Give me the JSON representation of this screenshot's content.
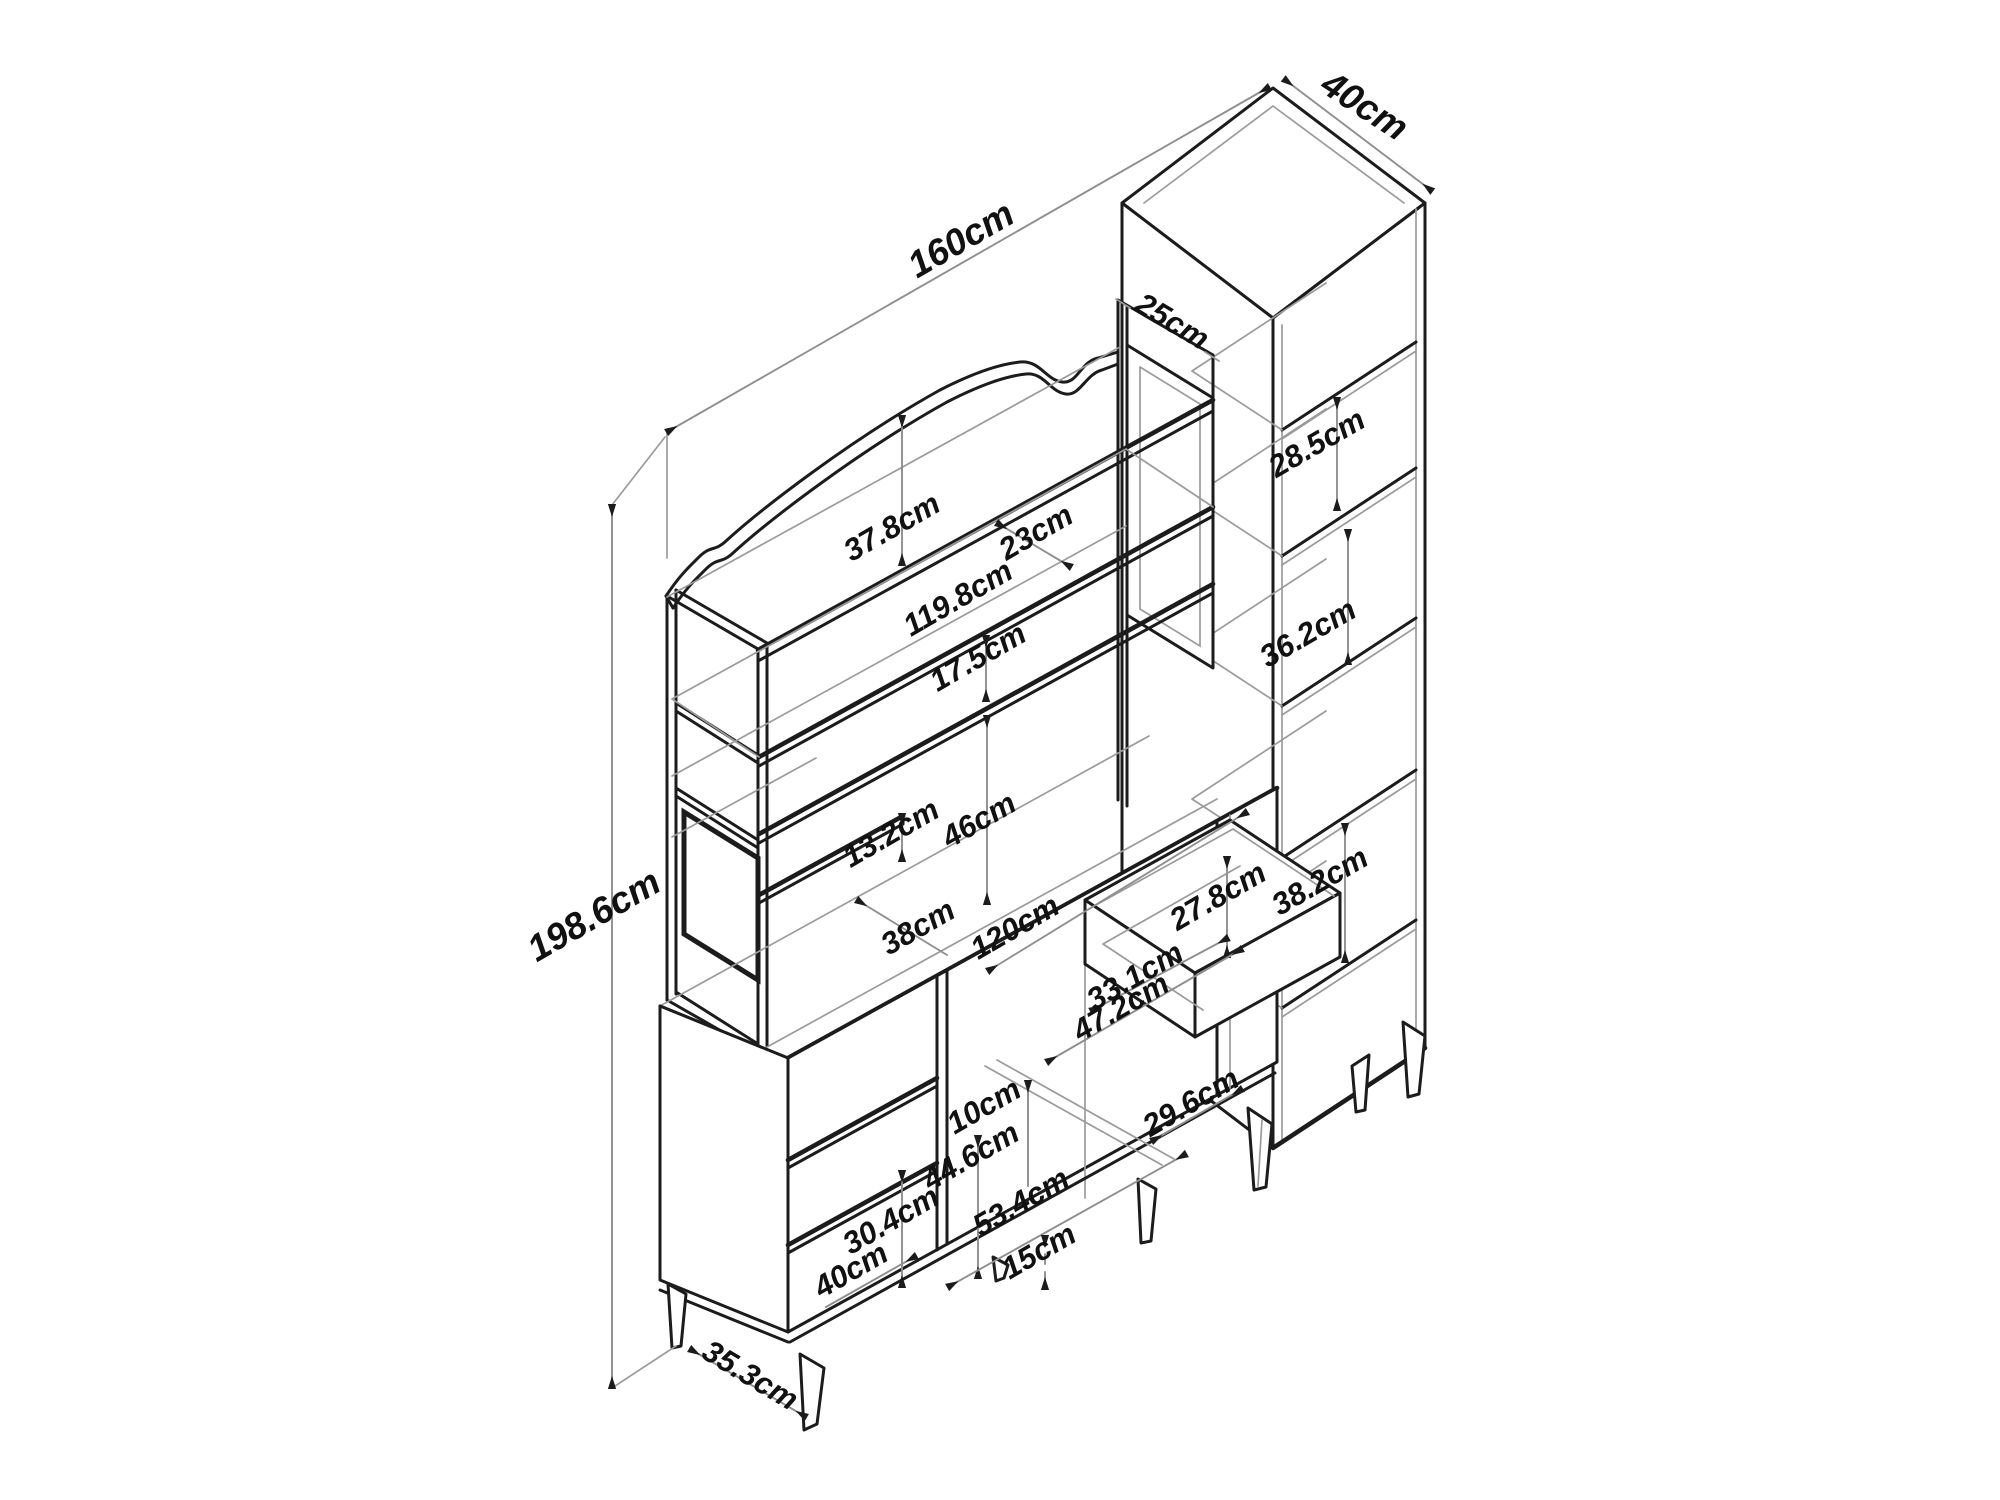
{
  "diagram_title": "furniture dimension drawing",
  "unit": "cm",
  "colors": {
    "line": "#1c1c1c",
    "dim_line": "#8f8f8f",
    "background": "#ffffff"
  },
  "dims": {
    "overall_width": "160cm",
    "overall_height": "198.6cm",
    "tower_depth": "40cm",
    "hutch_depth": "25cm",
    "tower_gap_top": "28.5cm",
    "tower_gap_middle": "36.2cm",
    "tower_gap_bottom": "38.2cm",
    "crest_height": "37.8cm",
    "top_shelf_depth": "23cm",
    "hutch_shelf_width": "119.8cm",
    "shelf_gap_upper": "17.5cm",
    "shelf_gap_lower": "13.2cm",
    "hutch_opening_height": "46cm",
    "side_shelf_width": "38cm",
    "desk_width": "120cm",
    "niche_height": "27.8cm",
    "drawer_inner_width": "33.1cm",
    "drawer_inner_depth": "47.2cm",
    "drawer_top_gap": "10cm",
    "base_gap_width": "29.6cm",
    "door_opening_height": "44.6cm",
    "cubby_height": "30.4cm",
    "base_rail_width": "53.4cm",
    "leg_height": "15cm",
    "bottom_shelf_width": "40cm",
    "base_depth": "35.3cm"
  }
}
